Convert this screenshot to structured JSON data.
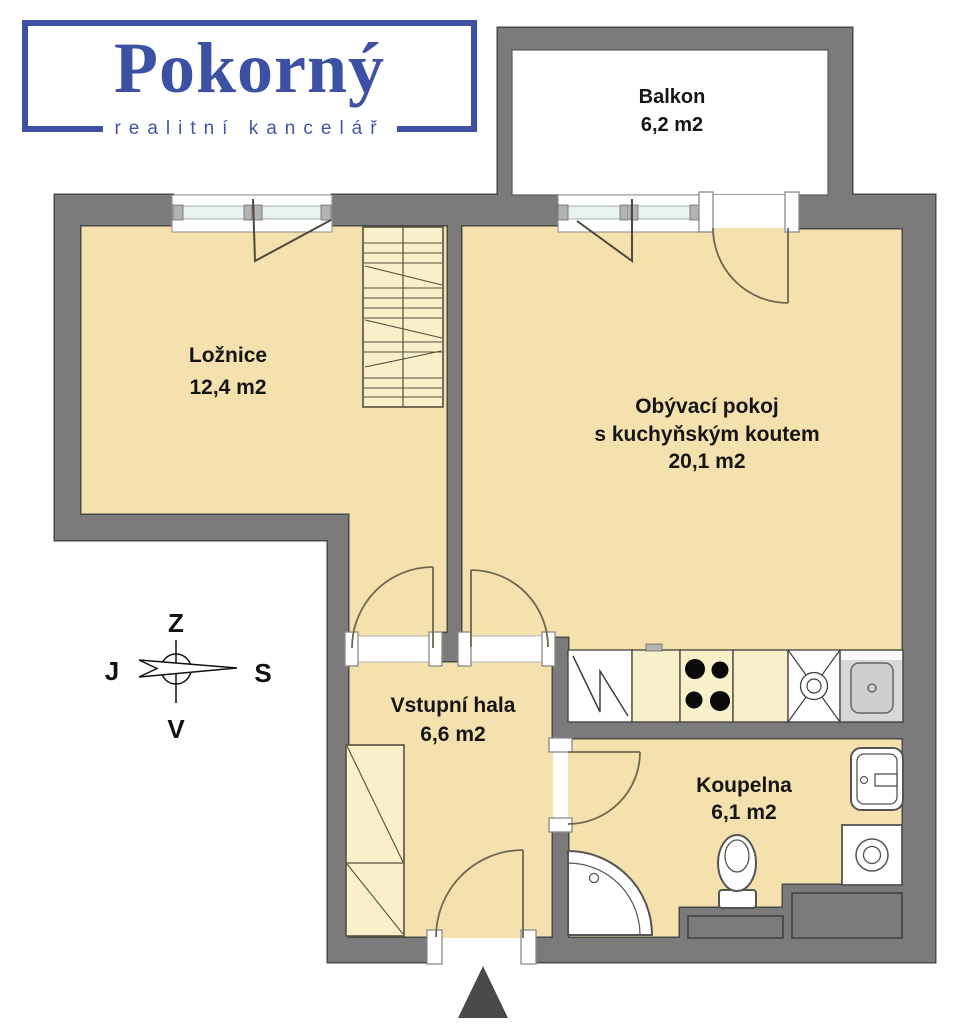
{
  "logo": {
    "brand": "Pokorný",
    "subtitle": "realitní kancelář"
  },
  "rooms": {
    "balkon": {
      "name": "Balkon",
      "area": "6,2 m2"
    },
    "loznice": {
      "name": "Ložnice",
      "area": "12,4 m2"
    },
    "obyvaci": {
      "name_line1": "Obývací pokoj",
      "name_line2": "s kuchyňským koutem",
      "area": "20,1 m2"
    },
    "hala": {
      "name": "Vstupní hala",
      "area": "6,6 m2"
    },
    "koupelna": {
      "name": "Koupelna",
      "area": "6,1 m2"
    }
  },
  "compass": {
    "top": "Z",
    "left": "J",
    "right": "S",
    "bottom": "V"
  },
  "colors": {
    "wall": "#7b7b7b",
    "wall_outline": "#4a4a4a",
    "floor": "#f4e1ad",
    "furniture": "#f7f0c8",
    "glass": "#e6f3f1",
    "logo_blue": "#3c51a3",
    "entrance_arrow": "#4a4a4a"
  }
}
